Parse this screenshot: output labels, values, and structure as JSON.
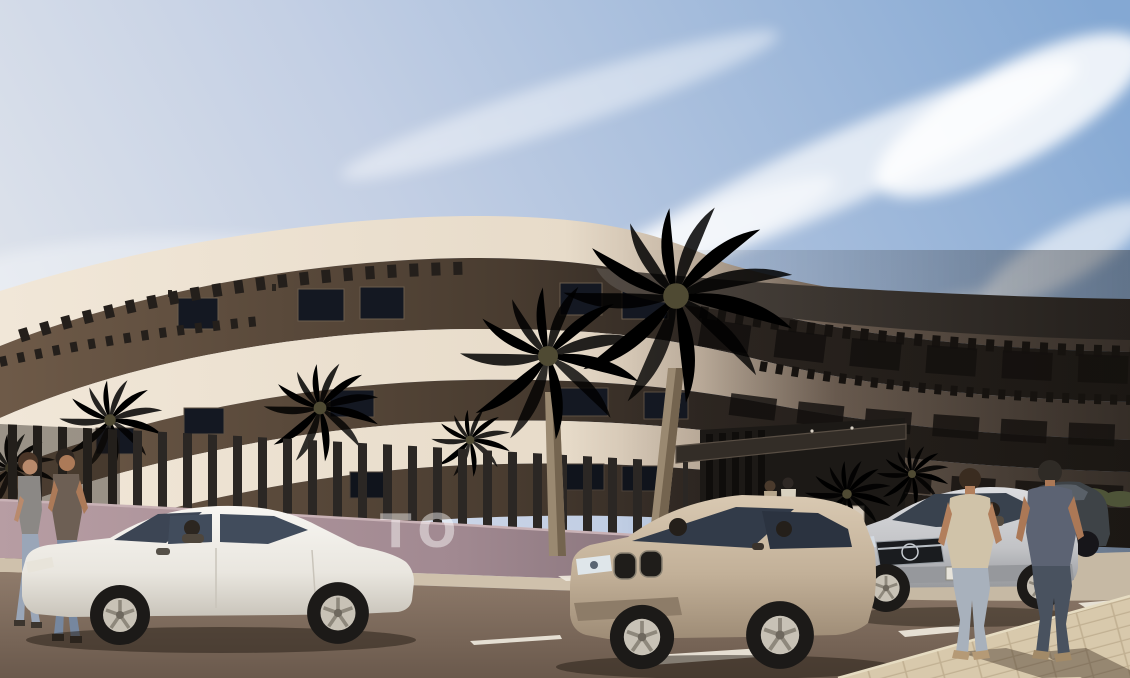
{
  "scene": {
    "label": "new-build-curved-apartment-complex-exterior-render",
    "wall_text": "TO",
    "building": {
      "style": "curved-modern-apartment-block",
      "floors_visible": 3,
      "features": [
        "rooftop-pergola-slats",
        "curved-cream-balcony-bands",
        "dark-recessed-glazing",
        "entrance-canopy",
        "slatted-privacy-fence"
      ]
    },
    "vehicles": [
      {
        "name": "white-sedan",
        "color": "#f1efe9"
      },
      {
        "name": "beige-suv",
        "color": "#c3b19b"
      },
      {
        "name": "silver-sedan",
        "color": "#c6c7c9"
      },
      {
        "name": "dark-parked-car",
        "color": "#3e4347"
      }
    ],
    "pedestrians": [
      {
        "name": "couple-walking-left"
      },
      {
        "name": "two-people-at-entrance"
      },
      {
        "name": "two-men-walking-away-right"
      }
    ],
    "vegetation": [
      "tall-palm-trees",
      "fence-line-palms",
      "planter-palm",
      "shrubs"
    ],
    "colors": {
      "sky_top": "#84a8d3",
      "sky_low": "#e9ebee",
      "facade_light": "#f1e7d8",
      "facade_shadow": "#463d36",
      "recess_dark": "#2e2722",
      "roof_dark": "#2c2825",
      "wall_mauve": "#b79da3",
      "fence_dark": "#2b2724",
      "road_asphalt": "#8f7b6b",
      "road_marking": "#efe9dd",
      "sidewalk_paver": "#d8c9ac",
      "palm_frond": "#8a8c5e",
      "palm_trunk": "#9a8971"
    }
  }
}
